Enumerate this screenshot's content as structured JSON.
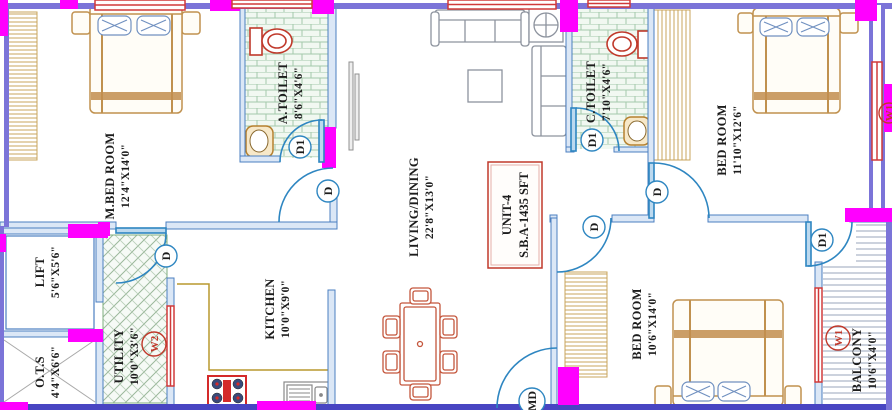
{
  "plan": {
    "unit_box": {
      "line1": "UNIT-4",
      "line2": "S.B.A-1435 SFT"
    },
    "rooms": [
      {
        "id": "m-bed-room",
        "name": "M.BED ROOM",
        "dims": "12'4\"X14'0\""
      },
      {
        "id": "a-toilet",
        "name": "A.TOILET",
        "dims": "8'6\"X4'6\""
      },
      {
        "id": "living-dining",
        "name": "LIVING/DINING",
        "dims": "22'8\"X13'0\""
      },
      {
        "id": "c-toilet",
        "name": "C.TOILET",
        "dims": "7'10\"X4'6\""
      },
      {
        "id": "bed-room-top",
        "name": "BED ROOM",
        "dims": "11'10\"X12'6\""
      },
      {
        "id": "lift",
        "name": "LIFT",
        "dims": "5'6\"X5'6\""
      },
      {
        "id": "ots",
        "name": "O.T.S",
        "dims": "4'4\"X6'6\""
      },
      {
        "id": "utility",
        "name": "UTILITY",
        "dims": "10'0\"X3'6\""
      },
      {
        "id": "kitchen",
        "name": "KITCHEN",
        "dims": "10'0\"X9'0\""
      },
      {
        "id": "bed-room-bottom",
        "name": "BED ROOM",
        "dims": "10'6\"X14'0\""
      },
      {
        "id": "balcony",
        "name": "BALCONY",
        "dims": "10'6\"X4'0\""
      }
    ],
    "doors": [
      {
        "label": "D1"
      },
      {
        "label": "D"
      },
      {
        "label": "D1"
      },
      {
        "label": "D"
      },
      {
        "label": "D"
      },
      {
        "label": "D"
      },
      {
        "label": "D1"
      },
      {
        "label": "MD"
      }
    ],
    "windows": [
      {
        "label": "W2"
      },
      {
        "label": "W1"
      },
      {
        "label": "W1"
      }
    ],
    "colors": {
      "column": "#ff00ff",
      "outer_wall": "#7b74d8",
      "outer_wall_bottom": "#4845c2",
      "inner_wall_stroke": "#4b7fc0",
      "door_blue": "#2e86c1",
      "window_red": "#d03a3a",
      "fixture_red": "#c0392b",
      "furniture_tan": "#c0914f",
      "dining_red": "#c4563c"
    }
  }
}
